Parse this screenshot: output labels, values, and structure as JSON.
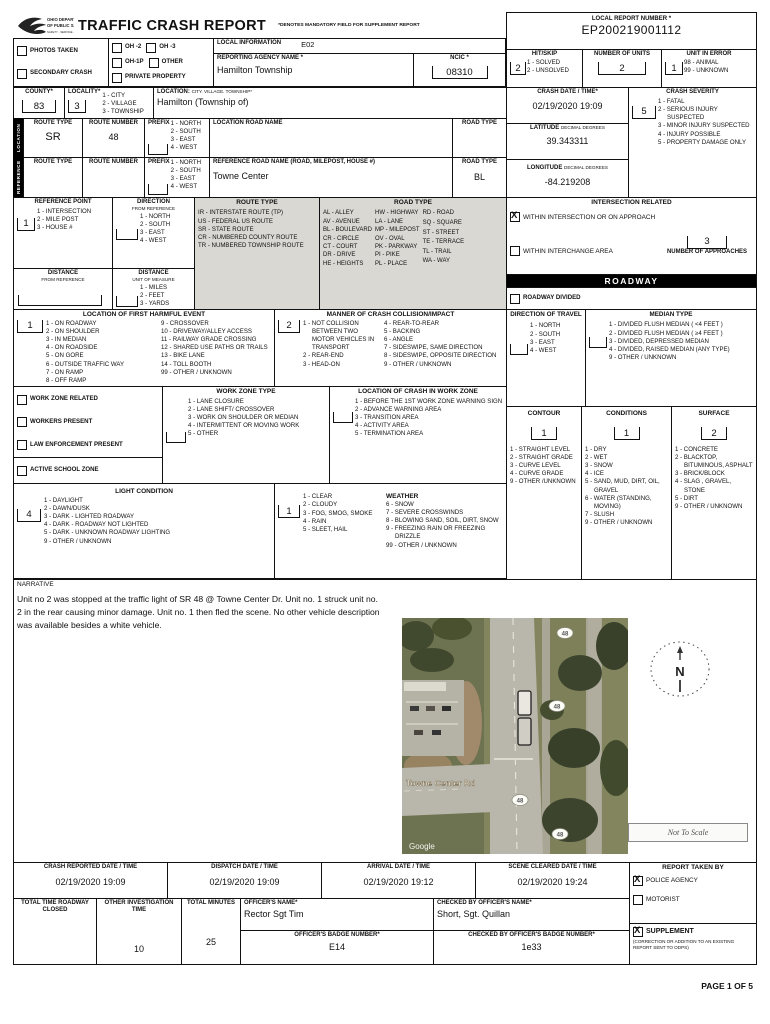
{
  "colors": {
    "line": "#111111",
    "legend_bg": "#d9d8d3",
    "bar_bg": "#000000",
    "bar_fg": "#ffffff",
    "map_grass": "#83855f",
    "map_road": "#b9b6ab",
    "map_tree": "#41492f"
  },
  "header": {
    "logo_line1": "OHIO DEPARTMENT",
    "logo_line2": "OF PUBLIC SAFETY",
    "logo_line3": "SAFETY - SERVICE - PROTECTION",
    "title": "TRAFFIC CRASH REPORT",
    "mandatory_note": "*DENOTES MANDATORY FIELD FOR SUPPLEMENT REPORT",
    "local_report_number": {
      "label": "LOCAL REPORT NUMBER *",
      "value": "EP200219001112"
    },
    "local_information": {
      "label": "LOCAL INFORMATION",
      "value": "E02"
    },
    "reporting_agency": {
      "label": "REPORTING AGENCY NAME *",
      "value": "Hamilton Township"
    },
    "ncic": {
      "label": "NCIC *",
      "value": "08310"
    },
    "photos_taken": {
      "label": "PHOTOS TAKEN",
      "checked": false
    },
    "secondary_crash": {
      "label": "SECONDARY CRASH",
      "checked": false
    },
    "oh2": {
      "label": "OH -2",
      "checked": false
    },
    "oh3": {
      "label": "OH -3",
      "checked": false
    },
    "oh1p": {
      "label": "OH-1P",
      "checked": false
    },
    "other": {
      "label": "OTHER",
      "checked": false
    },
    "private_property": {
      "label": "PRIVATE PROPERTY",
      "checked": false
    },
    "hit_skip": {
      "label": "HIT/SKIP",
      "value": "2",
      "options": [
        "1 - SOLVED",
        "2 - UNSOLVED"
      ]
    },
    "number_of_units": {
      "label": "NUMBER OF UNITS",
      "value": "2"
    },
    "unit_in_error": {
      "label": "UNIT IN ERROR",
      "value": "1",
      "options": [
        "98 - ANIMAL",
        "99 - UNKNOWN"
      ]
    }
  },
  "county": {
    "label": "COUNTY*",
    "value": "83"
  },
  "locality": {
    "label": "LOCALITY*",
    "value": "3",
    "options": [
      "1 - CITY",
      "2 - VILLAGE",
      "3 - TOWNSHIP"
    ]
  },
  "location_cvt": {
    "label": "LOCATION:",
    "label2": "CITY. VILLAGE. TOWNSHIP*",
    "value": "Hamilton (Township of)"
  },
  "crash_date": {
    "label": "CRASH DATE / TIME*",
    "value": "02/19/2020 19:09"
  },
  "crash_severity": {
    "label": "CRASH SEVERITY",
    "value": "5",
    "options": [
      "1 - FATAL",
      "2 - SERIOUS INJURY SUSPECTED",
      "3 - MINOR INJURY SUSPECTED",
      "4 - INJURY POSSIBLE",
      "5 - PROPERTY DAMAGE ONLY"
    ]
  },
  "latitude": {
    "label": "LATITUDE",
    "sub": "DECIMAL DEGREES",
    "value": "39.343311"
  },
  "longitude": {
    "label": "LONGITUDE",
    "sub": "DECIMAL DEGREES",
    "value": "-84.219208"
  },
  "prefix_options": [
    "1 - NORTH",
    "2 - SOUTH",
    "3 - EAST",
    "4 - WEST"
  ],
  "location_band": {
    "side_label": "LOCATION",
    "route_type": {
      "label": "ROUTE TYPE",
      "value": "SR"
    },
    "route_number": {
      "label": "ROUTE NUMBER",
      "value": "48"
    },
    "prefix_label": "PREFIX",
    "road_name": {
      "label": "LOCATION ROAD NAME",
      "value": ""
    },
    "road_type": {
      "label": "ROAD TYPE",
      "value": ""
    }
  },
  "reference_band": {
    "side_label": "REFERENCE",
    "route_type": {
      "label": "ROUTE TYPE",
      "value": ""
    },
    "route_number": {
      "label": "ROUTE NUMBER",
      "value": ""
    },
    "prefix_label": "PREFIX",
    "road_name": {
      "label": "REFERENCE ROAD NAME (ROAD, MILEPOST, HOUSE #)",
      "value": "Towne Center"
    },
    "road_type": {
      "label": "ROAD TYPE",
      "value": "BL"
    }
  },
  "reference_point": {
    "label": "REFERENCE POINT",
    "value": "1",
    "options": [
      "1 - INTERSECTION",
      "2 - MILE POST",
      "3 - HOUSE #"
    ]
  },
  "direction_from_ref": {
    "label": "DIRECTION",
    "sub": "FROM REFERENCE",
    "value": "",
    "options": [
      "1 - NORTH",
      "2 - SOUTH",
      "3 - EAST",
      "4 - WEST"
    ]
  },
  "distance_from_ref": {
    "label": "DISTANCE",
    "sub": "FROM REFERENCE",
    "value": ""
  },
  "distance_unit": {
    "label": "DISTANCE",
    "sub": "UNIT OF MEASURE",
    "value": "",
    "options": [
      "1 - MILES",
      "2 - FEET",
      "3 - YARDS"
    ]
  },
  "route_type_legend": {
    "title": "ROUTE TYPE",
    "options": [
      "IR - INTERSTATE ROUTE (TP)",
      "US - FEDERAL US ROUTE",
      "SR - STATE ROUTE",
      "CR - NUMBERED COUNTY ROUTE",
      "TR - NUMBERED TOWNSHIP ROUTE"
    ]
  },
  "road_type_legend": {
    "title": "ROAD TYPE",
    "col1": [
      "AL - ALLEY",
      "AV - AVENUE",
      "BL - BOULEVARD",
      "CR - CIRCLE",
      "CT - COURT",
      "DR - DRIVE",
      "HE - HEIGHTS"
    ],
    "col2": [
      "HW - HIGHWAY",
      "LA - LANE",
      "MP - MILEPOST",
      "OV - OVAL",
      "PK - PARKWAY",
      "PI - PIKE",
      "PL - PLACE"
    ],
    "col3": [
      "RD - ROAD",
      "SQ - SQUARE",
      "ST - STREET",
      "TE - TERRACE",
      "TL - TRAIL",
      "WA - WAY"
    ]
  },
  "intersection": {
    "title": "INTERSECTION RELATED",
    "within_intersection": {
      "label": "WITHIN INTERSECTION OR ON APPROACH",
      "checked": true
    },
    "within_interchange": {
      "label": "WITHIN INTERCHANGE AREA",
      "checked": false
    },
    "approaches": {
      "label": "NUMBER OF APPROACHES",
      "value": "3"
    }
  },
  "roadway": {
    "bar": "ROADWAY",
    "divided": {
      "label": "ROADWAY DIVIDED",
      "checked": false
    }
  },
  "first_harmful": {
    "title": "LOCATION OF FIRST HARMFUL EVENT",
    "value": "1",
    "col1": [
      "1 - ON ROADWAY",
      "2 - ON  SHOULDER",
      "3 - IN MEDIAN",
      "4 - ON ROADSIDE",
      "5 - ON GORE",
      "6 - OUTSIDE TRAFFIC WAY",
      "7 - ON RAMP",
      "8 - OFF RAMP"
    ],
    "col2": [
      "9 - CROSSOVER",
      "10 - DRIVEWAY/ALLEY ACCESS",
      "11 - RAILWAY GRADE CROSSING",
      "12 - SHARED USE PATHS OR TRAILS",
      "13 - BIKE LANE",
      "14 - TOLL BOOTH",
      "99 - OTHER / UNKNOWN"
    ]
  },
  "manner": {
    "title": "MANNER OF CRASH COLLISION/IMPACT",
    "value": "2",
    "col1": [
      "1 - NOT COLLISION BETWEEN TWO MOTOR VEHICLES IN TRANSPORT",
      "2 - REAR-END",
      "3 - HEAD-ON"
    ],
    "col2": [
      "4 - REAR-TO-REAR",
      "5 - BACKING",
      "6 - ANGLE",
      "7 - SIDESWIPE, SAME DIRECTION",
      "8 - SIDESWIPE, OPPOSITE DIRECTION",
      "9 - OTHER / UNKNOWN"
    ]
  },
  "direction_of_travel": {
    "title": "DIRECTION OF TRAVEL",
    "value": "",
    "options": [
      "1 - NORTH",
      "2 - SOUTH",
      "3 - EAST",
      "4 - WEST"
    ]
  },
  "median_type": {
    "title": "MEDIAN TYPE",
    "value": "",
    "options": [
      "1 - DIVIDED FLUSH MEDIAN ( <4 FEET )",
      "2 - DIVIDED FLUSH MEDIAN ( ≥4 FEET )",
      "3 - DIVIDED, DEPRESSED MEDIAN",
      "4 - DIVIDED, RAISED MEDIAN (ANY TYPE)",
      "9 - OTHER / UNKNOWN"
    ]
  },
  "work_zone": {
    "related": {
      "label": "WORK ZONE RELATED",
      "checked": false
    },
    "workers": {
      "label": "WORKERS PRESENT",
      "checked": false
    },
    "law": {
      "label": "LAW ENFORCEMENT PRESENT",
      "checked": false
    },
    "school": {
      "label": "ACTIVE SCHOOL ZONE",
      "checked": false
    },
    "type": {
      "title": "WORK ZONE TYPE",
      "value": "",
      "options": [
        "1 - LANE CLOSURE",
        "2 - LANE SHIFT/ CROSSOVER",
        "3 - WORK ON SHOULDER OR MEDIAN",
        "4 - INTERMITTENT OR MOVING WORK",
        "5 - OTHER"
      ]
    },
    "crash_location": {
      "title": "LOCATION OF CRASH IN WORK ZONE",
      "value": "",
      "options": [
        "1 - BEFORE THE 1ST WORK ZONE WARNING SIGN",
        "2 - ADVANCE WARNING AREA",
        "3 - TRANSITION  AREA",
        "4 - ACTIVITY AREA",
        "5 - TERMINATION AREA"
      ]
    }
  },
  "contour": {
    "title": "CONTOUR",
    "value": "1",
    "options": [
      "1 - STRAIGHT LEVEL",
      "2 - STRAIGHT GRADE",
      "3 - CURVE LEVEL",
      "4 - CURVE GRADE",
      "9 - OTHER /UNKNOWN"
    ]
  },
  "conditions": {
    "title": "CONDITIONS",
    "value": "1",
    "options": [
      "1 - DRY",
      "2 - WET",
      "3 - SNOW",
      "4 - ICE",
      "5 - SAND, MUD, DIRT, OIL, GRAVEL",
      "6 - WATER (STANDING, MOVING)",
      "7 - SLUSH",
      "9 - OTHER / UNKNOWN"
    ]
  },
  "surface": {
    "title": "SURFACE",
    "value": "2",
    "options": [
      "1 - CONCRETE",
      "2 - BLACKTOP, BITUMINOUS, ASPHALT",
      "3 - BRICK/BLOCK",
      "4 - SLAG , GRAVEL, STONE",
      "5 - DIRT",
      "9 - OTHER / UNKNOWN"
    ]
  },
  "light_condition": {
    "title": "LIGHT CONDITION",
    "value": "4",
    "options": [
      "1 - DAYLIGHT",
      "2 - DAWN/DUSK",
      "3 - DARK - LIGHTED ROADWAY",
      "4 - DARK -  ROADWAY NOT LIGHTED",
      "5 - DARK - UNKNOWN  ROADWAY LIGHTING",
      "9 - OTHER / UNKNOWN"
    ]
  },
  "weather": {
    "title": "WEATHER",
    "value": "1",
    "col1": [
      "1 - CLEAR",
      "2 - CLOUDY",
      "3 - FOG, SMOG, SMOKE",
      "4 - RAIN",
      "5 - SLEET, HAIL"
    ],
    "col2": [
      "6 - SNOW",
      "7 - SEVERE CROSSWINDS",
      "8 - BLOWING SAND, SOIL, DIRT, SNOW",
      "9 - FREEZING RAIN OR FREEZING DRIZZLE",
      "99 - OTHER / UNKNOWN"
    ]
  },
  "narrative": {
    "label": "NARRATIVE",
    "text": "Unit no 2 was stopped at the traffic light of SR 48 @ Towne Center Dr. Unit no. 1 struck unit no. 2 in the rear causing minor damage. Unit no. 1 then fled the scene. No other vehicle description was available besides a white vehicle."
  },
  "map": {
    "road_label": "Towne Center Rd",
    "shield": "48",
    "google": "Google",
    "not_to_scale": "Not To Scale",
    "compass": "N"
  },
  "times": {
    "crash_reported": {
      "label": "CRASH REPORTED DATE / TIME",
      "value": "02/19/2020 19:09"
    },
    "dispatch": {
      "label": "DISPATCH DATE / TIME",
      "value": "02/19/2020 19:09"
    },
    "arrival": {
      "label": "ARRIVAL DATE / TIME",
      "value": "02/19/2020 19:12"
    },
    "scene_cleared": {
      "label": "SCENE CLEARED DATE / TIME",
      "value": "02/19/2020 19:24"
    }
  },
  "report_taken": {
    "title": "REPORT TAKEN BY",
    "police": {
      "label": "POLICE AGENCY",
      "checked": true
    },
    "motorist": {
      "label": "MOTORIST",
      "checked": false
    },
    "supplement": {
      "label": "SUPPLEMENT",
      "checked": true,
      "note": "(CORRECTION OR ADDITION TO AN EXISTING REPORT SENT TO ODPS)"
    }
  },
  "bottom": {
    "total_time": {
      "label": "TOTAL TIME ROADWAY CLOSED",
      "value": ""
    },
    "other_invest": {
      "label": "OTHER INVESTIGATION TIME",
      "value": "10"
    },
    "total_minutes": {
      "label": "TOTAL MINUTES",
      "value": "25"
    },
    "officer_name": {
      "label": "OFFICER'S NAME*",
      "value": "Rector Sgt Tim"
    },
    "checked_by_name": {
      "label": "CHECKED BY OFFICER'S NAME*",
      "value": "Short, Sgt. Quillan"
    },
    "badge": {
      "label": "OFFICER'S BADGE NUMBER*",
      "value": "E14"
    },
    "checked_by_badge": {
      "label": "CHECKED BY OFFICER'S BADGE NUMBER*",
      "value": "1e33"
    }
  },
  "footer": {
    "page": "PAGE 1 OF 5"
  }
}
